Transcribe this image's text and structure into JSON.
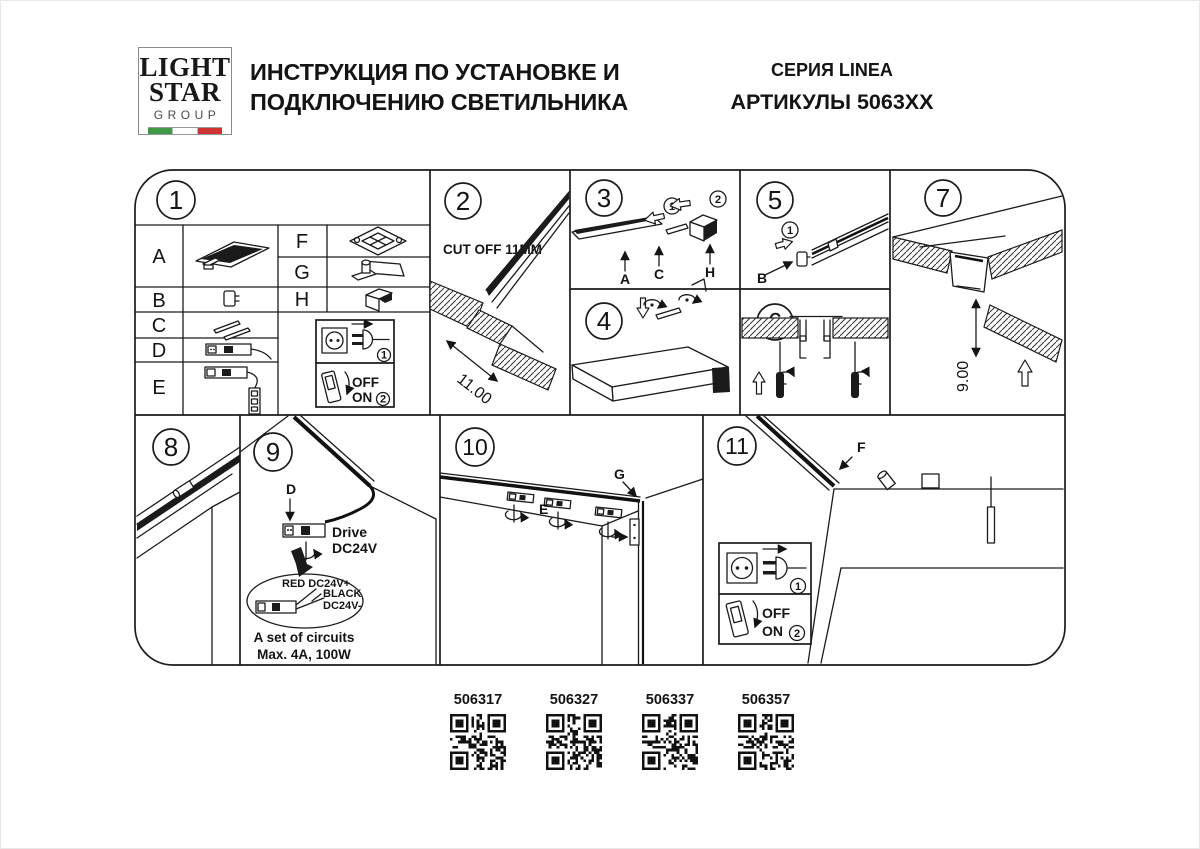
{
  "header": {
    "logo_line1": "LIGHT",
    "logo_line2": "STAR",
    "logo_line3": "GROUP",
    "title_line1": "ИНСТРУКЦИЯ ПО УСТАНОВКЕ И",
    "title_line2": "ПОДКЛЮЧЕНИЮ СВЕТИЛЬНИКА",
    "series": "СЕРИЯ LINEA",
    "articles": "АРТИКУЛЫ 5063XX"
  },
  "colors": {
    "line": "#1b1b1b",
    "flag_green": "#3f9a47",
    "flag_red": "#cf3434"
  },
  "steps": {
    "s1": "1",
    "s2": "2",
    "s3": "3",
    "s4": "4",
    "s5": "5",
    "s6": "6",
    "s7": "7",
    "s8": "8",
    "s9": "9",
    "s10": "10",
    "s11": "11"
  },
  "panel1": {
    "parts_left": [
      "A",
      "B",
      "C",
      "D",
      "E"
    ],
    "parts_right": [
      "F",
      "G",
      "H"
    ]
  },
  "panel2": {
    "note": "CUT OFF 11MM",
    "dim": "11.00"
  },
  "panel3": {
    "step_a": "1",
    "step_b": "2",
    "label_a": "A",
    "label_c": "C",
    "label_h": "H"
  },
  "panel5": {
    "step": "1",
    "label_b": "B"
  },
  "panel7": {
    "dim": "9.00"
  },
  "panel9": {
    "label_d": "D",
    "drive_line1": "Drive",
    "drive_line2": "DC24V",
    "wire_red": "RED DC24V+",
    "wire_black_line1": "BLACK",
    "wire_black_line2": "DC24V-",
    "note_line1": "A set of circuits",
    "note_line2": "Max. 4A, 100W"
  },
  "panel10": {
    "label_e": "E",
    "label_g": "G"
  },
  "panel11": {
    "label_f": "F"
  },
  "power": {
    "step_plug": "1",
    "step_switch": "2",
    "off": "OFF",
    "on": "ON"
  },
  "qr": {
    "codes": [
      "506317",
      "506327",
      "506337",
      "506357"
    ]
  }
}
